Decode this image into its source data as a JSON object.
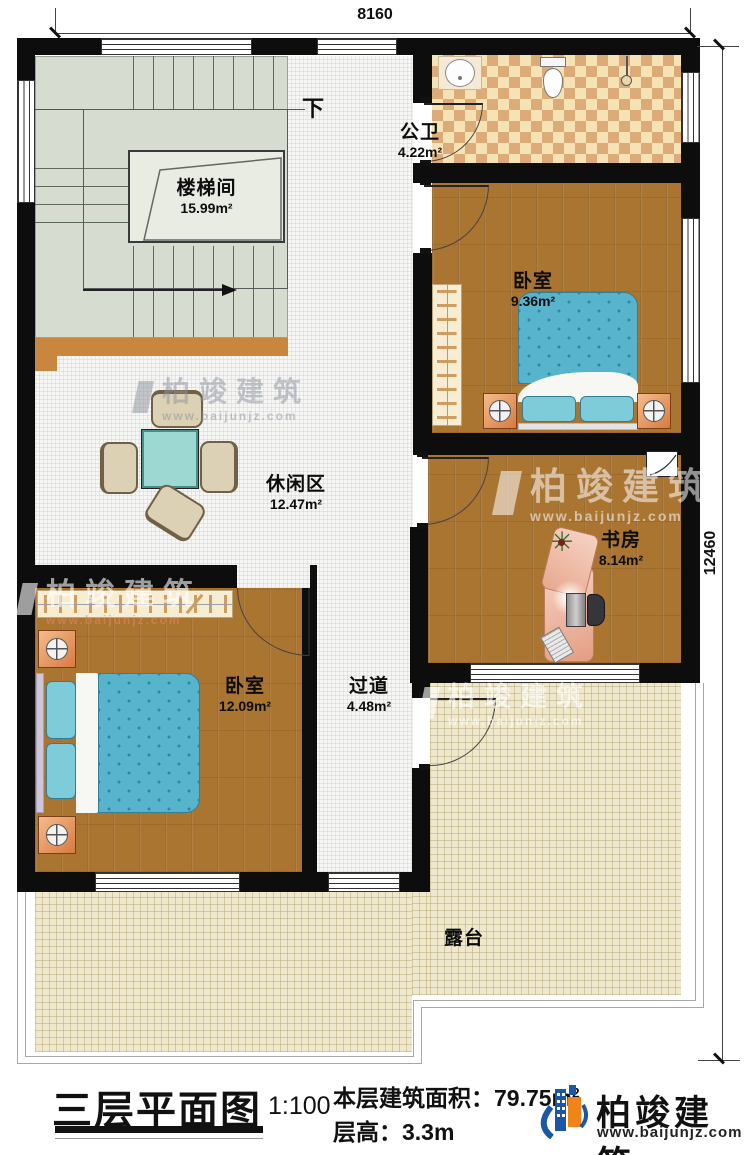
{
  "dimensions": {
    "top": "8160",
    "right": "12460"
  },
  "stairs": {
    "down_label": "下"
  },
  "rooms": [
    {
      "id": "stairwell",
      "name": "楼梯间",
      "area": "15.99m²"
    },
    {
      "id": "bathroom",
      "name": "公卫",
      "area": "4.22m²"
    },
    {
      "id": "bedroom1",
      "name": "卧室",
      "area": "9.36m²"
    },
    {
      "id": "study",
      "name": "书房",
      "area": "8.14m²"
    },
    {
      "id": "leisure",
      "name": "休闲区",
      "area": "12.47m²"
    },
    {
      "id": "corridor",
      "name": "过道",
      "area": "4.48m²"
    },
    {
      "id": "bedroom2",
      "name": "卧室",
      "area": "12.09m²"
    },
    {
      "id": "terrace",
      "name": "露台",
      "area": ""
    }
  ],
  "title_block": {
    "title": "三层平面图",
    "scale": "1:100",
    "area_label": "本层建筑面积：79.75m",
    "area_sup": "2",
    "floor_height": "层高：3.3m"
  },
  "brand": {
    "name": "柏竣建筑",
    "url": "www.baijunjz.com"
  },
  "watermark": {
    "name": "柏竣建筑",
    "url": "www.baijunjz.com"
  },
  "colors": {
    "wall": "#0d0d0d",
    "wood_floor": "#aa7431",
    "stair_floor": "#d6ddd0",
    "bath_checker_light": "#f6e3b5",
    "bath_checker_dark": "#dcab77",
    "terrace_floor": "#efe8cc",
    "bed_blue": "#58b3cd",
    "table_teal": "#9ed8d2",
    "brand_blue": "#1c57a5",
    "brand_orange": "#f08418"
  }
}
